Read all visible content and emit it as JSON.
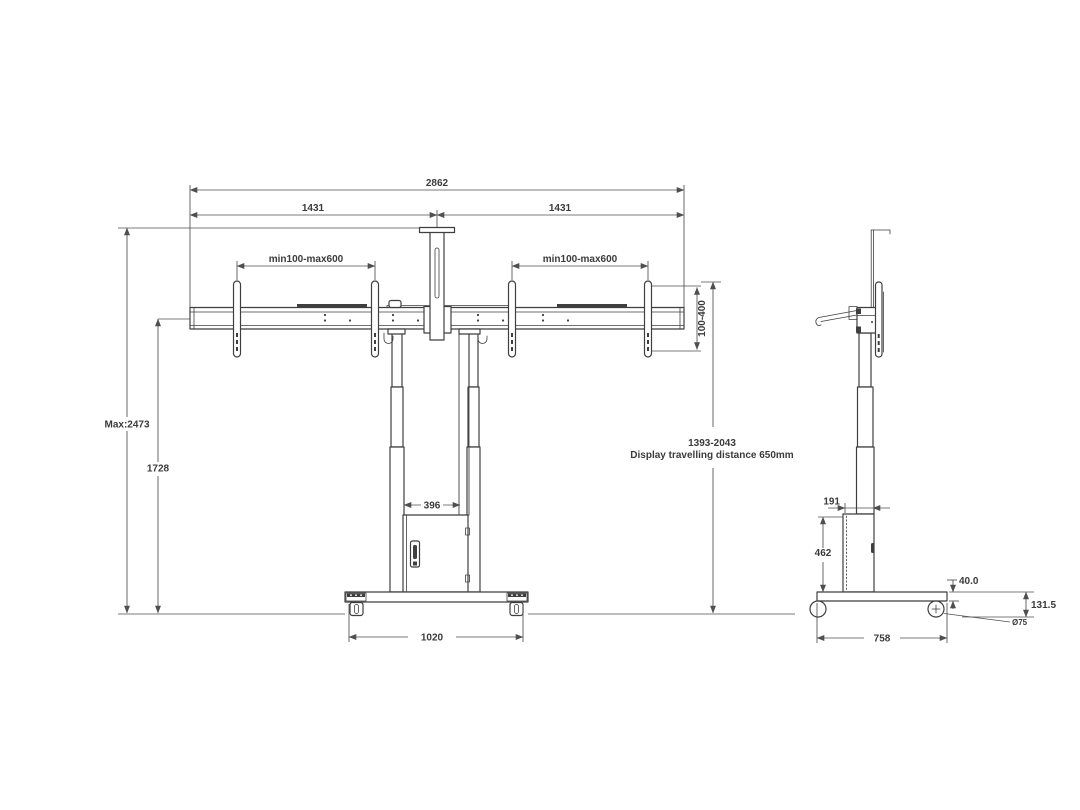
{
  "drawing_title": "Dual display floor lift stand dimensional drawing",
  "colors": {
    "background": "#ffffff",
    "part_outline": "#3f3f3f",
    "dimension_line": "#4f4f4f",
    "dimension_text": "#3b3b3b"
  },
  "front": {
    "name": "front-view",
    "dims": {
      "total_width": "2862",
      "left_half": "1431",
      "right_half": "1431",
      "vesa_range_left": "min100-max600",
      "vesa_range_right": "min100-max600",
      "vesa_height_range": "100-400",
      "max_height": "Max:2473",
      "beam_height": "1728",
      "enclosure_width": "396",
      "base_width": "1020",
      "display_height_range": "1393-2043",
      "travel_note": "Display travelling distance 650mm"
    }
  },
  "side": {
    "name": "side-view",
    "dims": {
      "enclosure_depth": "191",
      "enclosure_height": "462",
      "base_plate_thickness": "40.0",
      "base_height": "131.5",
      "caster_diameter": "Ø75",
      "base_depth": "758"
    }
  }
}
